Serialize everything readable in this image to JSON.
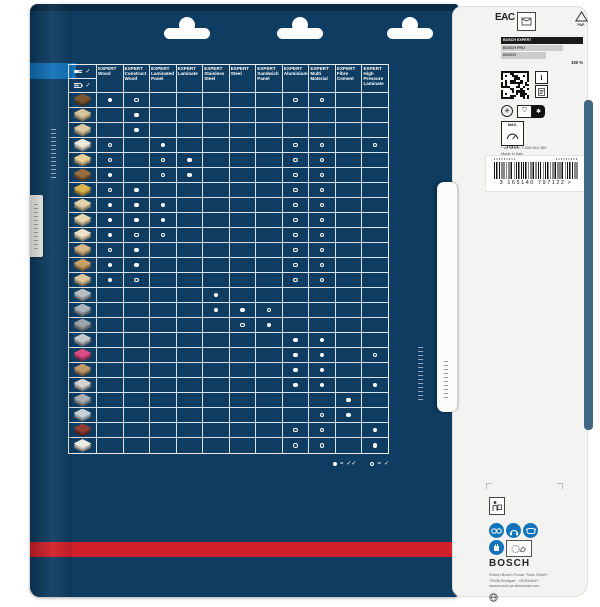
{
  "front": {
    "tool_header": {
      "corded_icon": "corded-tool-icon",
      "corded_check": "✓",
      "cordless_icon": "cordless-tool-icon",
      "cordless_check": "✓"
    },
    "columns": [
      {
        "brand": "EXPERT",
        "name": "Wood"
      },
      {
        "brand": "EXPERT",
        "name": "Construct Wood"
      },
      {
        "brand": "EXPERT",
        "name": "Laminated Panel"
      },
      {
        "brand": "EXPERT",
        "name": "Laminate"
      },
      {
        "brand": "EXPERT",
        "name": "Stainless Steel"
      },
      {
        "brand": "EXPERT",
        "name": "Steel"
      },
      {
        "brand": "EXPERT",
        "name": "Sandwich Panel"
      },
      {
        "brand": "EXPERT",
        "name": "Aluminium"
      },
      {
        "brand": "EXPERT",
        "name": "Multi Material"
      },
      {
        "brand": "EXPERT",
        "name": "Fibre Cement"
      },
      {
        "brand": "EXPERT",
        "name": "High Pressure Laminate"
      }
    ],
    "legend": {
      "filled_meaning": "✓✓",
      "hollow_meaning": "✓",
      "equals": "="
    },
    "rows": [
      {
        "material": "solid-wood",
        "color": "#7b5633",
        "cells": [
          2,
          1,
          0,
          0,
          0,
          0,
          0,
          1,
          1,
          0,
          0
        ]
      },
      {
        "material": "timber-stack",
        "color": "#d8c49a",
        "cells": [
          0,
          2,
          0,
          0,
          0,
          0,
          0,
          0,
          0,
          0,
          0
        ]
      },
      {
        "material": "construction-panel",
        "color": "#dcc9a2",
        "cells": [
          0,
          2,
          0,
          0,
          0,
          0,
          0,
          0,
          0,
          0,
          0
        ]
      },
      {
        "material": "coated-chipboard",
        "color": "#eee8da",
        "cells": [
          1,
          0,
          2,
          0,
          0,
          0,
          0,
          1,
          1,
          0,
          1
        ]
      },
      {
        "material": "softwood-panel",
        "color": "#e7cf96",
        "cells": [
          1,
          0,
          1,
          2,
          0,
          0,
          0,
          1,
          1,
          0,
          0
        ]
      },
      {
        "material": "hardwood",
        "color": "#996c3e",
        "cells": [
          2,
          0,
          1,
          2,
          0,
          0,
          0,
          1,
          1,
          0,
          0
        ]
      },
      {
        "material": "osb-board",
        "color": "#d9b44e",
        "cells": [
          1,
          2,
          0,
          0,
          0,
          0,
          0,
          1,
          1,
          0,
          0
        ]
      },
      {
        "material": "chipboard",
        "color": "#e4d2ab",
        "cells": [
          2,
          2,
          2,
          0,
          0,
          0,
          0,
          1,
          1,
          0,
          0
        ]
      },
      {
        "material": "mdf-board",
        "color": "#e6d6b2",
        "cells": [
          2,
          2,
          2,
          0,
          0,
          0,
          0,
          1,
          1,
          0,
          0
        ]
      },
      {
        "material": "light-building-board",
        "color": "#ece0c6",
        "cells": [
          2,
          1,
          1,
          0,
          0,
          0,
          0,
          1,
          1,
          0,
          0
        ]
      },
      {
        "material": "textured-board",
        "color": "#d3b787",
        "cells": [
          1,
          2,
          0,
          0,
          0,
          0,
          0,
          1,
          1,
          0,
          0
        ]
      },
      {
        "material": "parquet",
        "color": "#c7a066",
        "cells": [
          2,
          2,
          0,
          0,
          0,
          0,
          0,
          1,
          1,
          0,
          0
        ]
      },
      {
        "material": "laminate-flooring",
        "color": "#dcc69c",
        "cells": [
          2,
          1,
          0,
          0,
          0,
          0,
          0,
          1,
          1,
          0,
          0
        ]
      },
      {
        "material": "stainless-sheet",
        "color": "#b9bec4",
        "cells": [
          0,
          0,
          0,
          0,
          2,
          0,
          0,
          0,
          0,
          0,
          0
        ]
      },
      {
        "material": "corrugated-steel",
        "color": "#aab1b8",
        "cells": [
          0,
          0,
          0,
          0,
          2,
          2,
          1,
          0,
          0,
          0,
          0
        ]
      },
      {
        "material": "steel-profile",
        "color": "#9ba3ab",
        "cells": [
          0,
          0,
          0,
          0,
          0,
          1,
          2,
          0,
          0,
          0,
          0
        ]
      },
      {
        "material": "aluminium-sheets",
        "color": "#c3c8cd",
        "cells": [
          0,
          0,
          0,
          0,
          0,
          0,
          0,
          2,
          2,
          0,
          0
        ]
      },
      {
        "material": "insulation-panel",
        "color": "#d84a80",
        "cells": [
          0,
          0,
          0,
          0,
          0,
          0,
          0,
          2,
          2,
          0,
          1
        ]
      },
      {
        "material": "wood-with-metal",
        "color": "#c09a6a",
        "cells": [
          0,
          0,
          0,
          0,
          0,
          0,
          0,
          2,
          2,
          0,
          0
        ]
      },
      {
        "material": "multi-material-board",
        "color": "#d3d3d0",
        "cells": [
          0,
          0,
          0,
          0,
          0,
          0,
          0,
          2,
          2,
          0,
          2
        ]
      },
      {
        "material": "fibre-cement-board",
        "color": "#a9afb5",
        "cells": [
          0,
          0,
          0,
          0,
          0,
          0,
          0,
          0,
          0,
          2,
          0
        ]
      },
      {
        "material": "plasterboard",
        "color": "#c7d2d8",
        "cells": [
          0,
          0,
          0,
          0,
          0,
          0,
          0,
          0,
          1,
          2,
          0
        ]
      },
      {
        "material": "hpl-dark-board",
        "color": "#8f3c34",
        "cells": [
          0,
          0,
          0,
          0,
          0,
          0,
          0,
          1,
          1,
          0,
          2
        ]
      },
      {
        "material": "hpl-layered-board",
        "color": "#eceae2",
        "cells": [
          0,
          0,
          0,
          0,
          0,
          0,
          0,
          1,
          1,
          0,
          2
        ]
      }
    ],
    "accent_red": "#d2202a",
    "front_blue": "#0e3d61",
    "tab_blue": "#1173ba"
  },
  "panel": {
    "eac_label": "EAC",
    "pap_label": "PAP",
    "compare_chart": {
      "type": "bar",
      "categories": [
        "BOSCH EXPERT",
        "BOSCH PRO",
        "BOSCH"
      ],
      "values": [
        100,
        75,
        55
      ],
      "value_label": "100 %",
      "bar_colors": [
        "#1a1a1a",
        "#cccccb",
        "#cccccb"
      ],
      "label_colors": [
        "#ffffff",
        "#444444",
        "#444444"
      ]
    },
    "info_glyph": "i",
    "max_label": "MAX.",
    "note": "* vs. Bosch 2 608 644 369",
    "made_in": "Made in Italy",
    "barcode": {
      "digits": "3 165140 797122",
      "suffix": ">"
    },
    "brand": "BOSCH",
    "address_lines": [
      "Robert Bosch Power Tools GmbH",
      "70538 Stuttgart · GERMANY",
      "www.bosch-professional.com"
    ]
  }
}
